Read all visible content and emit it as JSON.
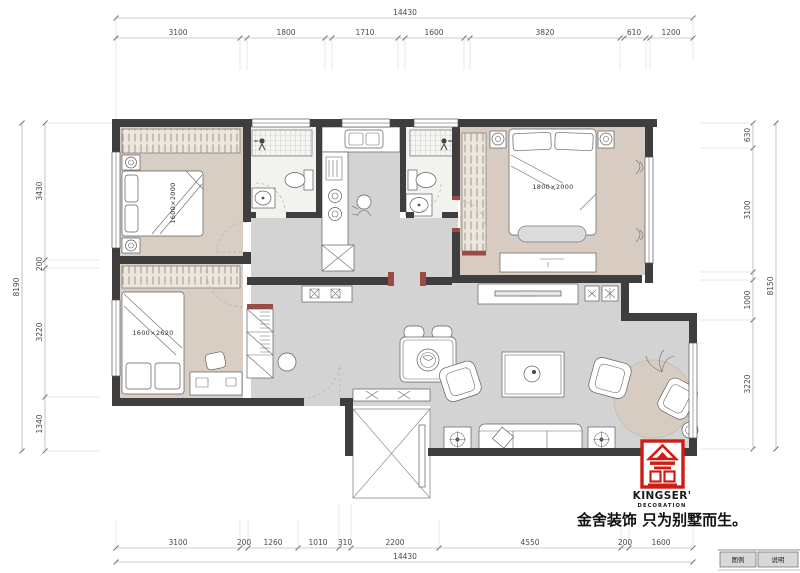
{
  "dims": {
    "top_overall": "14430",
    "top": [
      "3100",
      "1800",
      "1710",
      "1600",
      "3820",
      "610",
      "1200"
    ],
    "bottom": [
      "3100",
      "200",
      "1260",
      "1010",
      "310",
      "2200",
      "4550",
      "200",
      "1600"
    ],
    "bottom_overall": "14430",
    "left": [
      "3430",
      "200",
      "3220",
      "1340"
    ],
    "left_overall": "8190",
    "right": [
      "630",
      "3100",
      "1000",
      "3220"
    ],
    "right_overall": "8150"
  },
  "rooms": {
    "bedroom1_bed": "1600×2000",
    "bedroom2_bed": "1600×2620",
    "master_bed": "1800×2000"
  },
  "branding": {
    "name": "KINGSER'",
    "subtitle": "DECORATION",
    "slogan": "金舍装饰 只为别墅而生。",
    "logo_color": "#cf1d15"
  },
  "legend": {
    "legend_label": "图例",
    "note_label": "说明"
  },
  "colors": {
    "wall": "#3e3e3e",
    "bedroom_floor": "#d9cec4",
    "living_floor": "#d3d3d3",
    "accent_red": "#9e4a40"
  }
}
